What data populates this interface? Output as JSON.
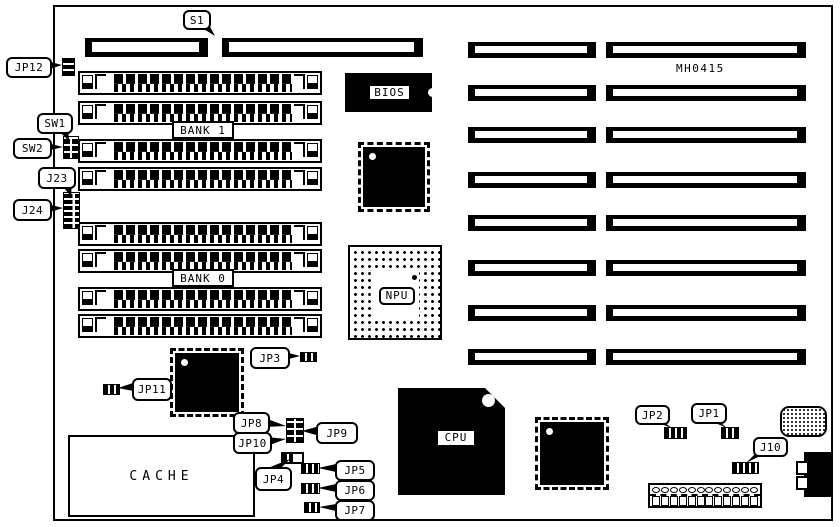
{
  "board": {
    "code": "MH0415",
    "banks": {
      "bank1": "BANK 1",
      "bank0": "BANK 0"
    },
    "chips": {
      "bios": "BIOS",
      "npu": "NPU",
      "cpu": "CPU",
      "cache": "CACHE"
    },
    "callouts": {
      "s1": "S1",
      "jp12": "JP12",
      "sw1": "SW1",
      "sw2": "SW2",
      "j23": "J23",
      "j24": "J24",
      "jp3": "JP3",
      "jp11": "JP11",
      "jp8": "JP8",
      "jp9": "JP9",
      "jp10": "JP10",
      "jp4": "JP4",
      "jp5": "JP5",
      "jp6": "JP6",
      "jp7": "JP7",
      "jp2": "JP2",
      "jp1": "JP1",
      "j10": "J10"
    },
    "power_connector": {
      "pins": 12
    }
  }
}
